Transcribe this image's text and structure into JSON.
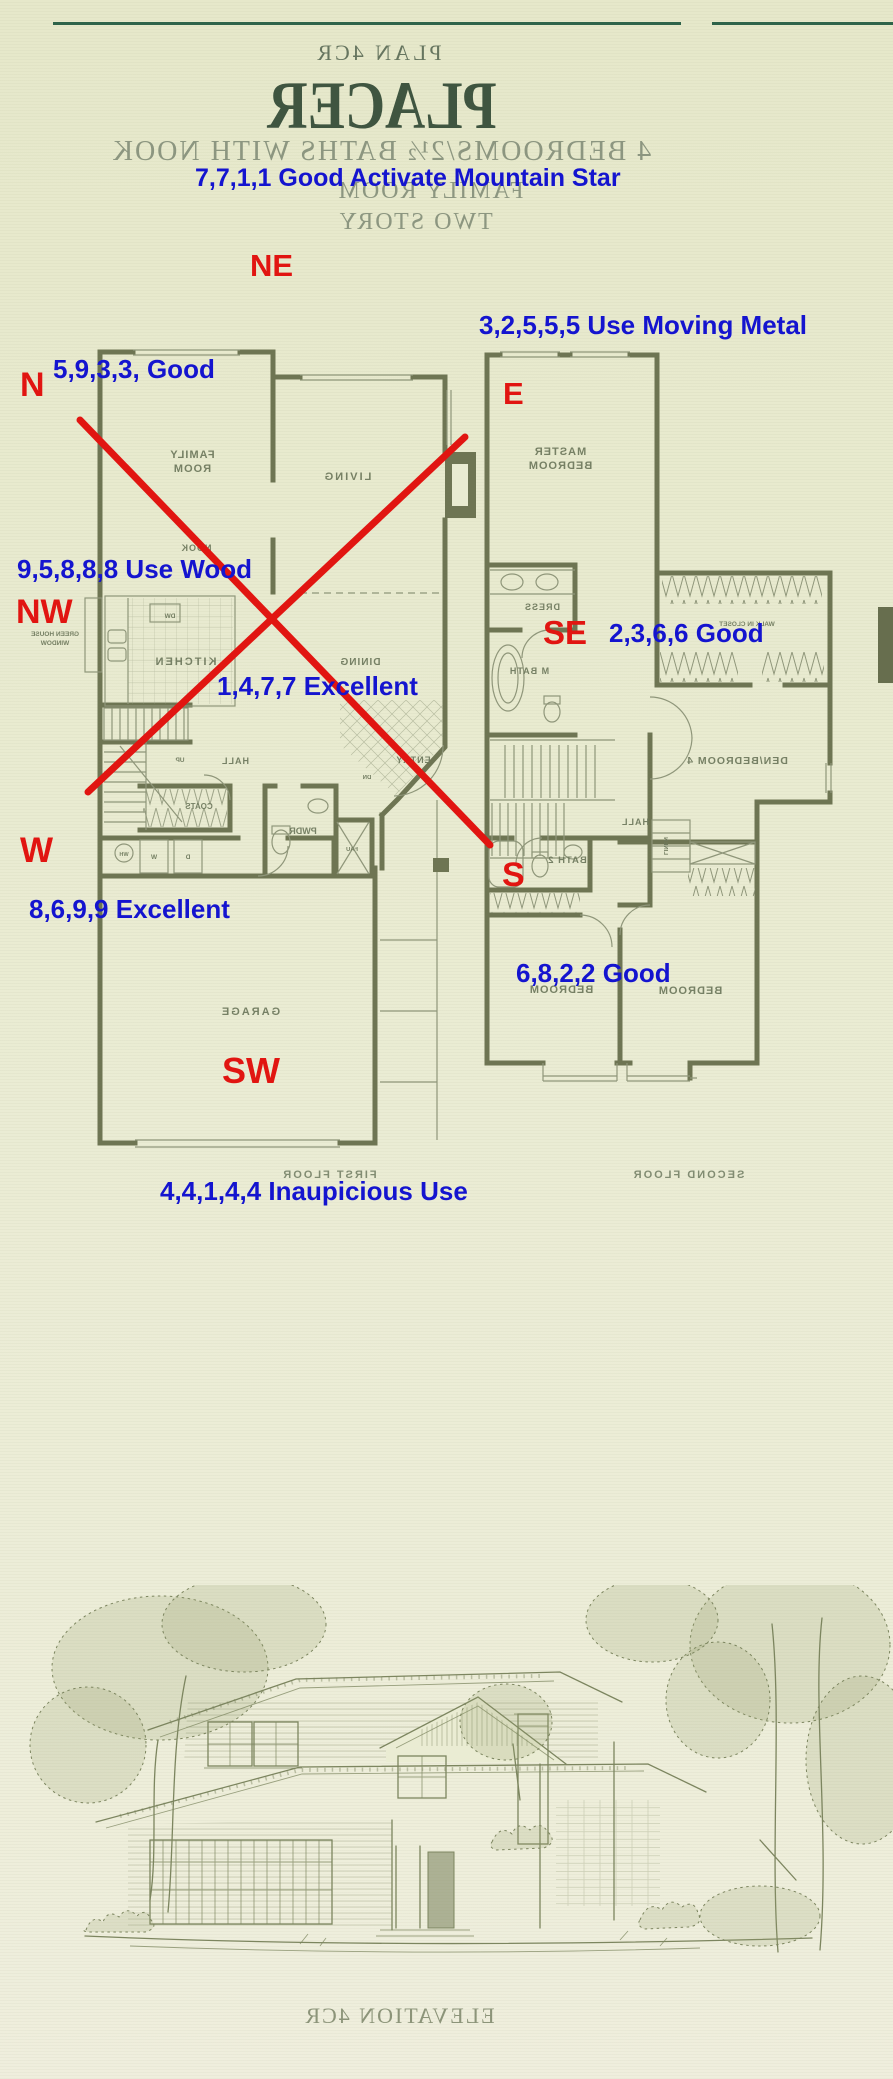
{
  "colors": {
    "blue": "#1414cf",
    "red": "#e11511",
    "wall": "#6e7553",
    "ink": "#7c855f",
    "title": "#3f5540",
    "faded": "#8c9680",
    "rule": "#2e6349"
  },
  "header": {
    "plan_code": "PLAN 4CR",
    "title": "PLACER",
    "subtitle": "4 BEDROOMS/2½ BATHS WITH NOOK",
    "line_family_room": "FAMILY ROOM",
    "line_two_story": "TWO STORY"
  },
  "feng_shui": {
    "notes": [
      {
        "text": "7,7,1,1 Good Activate Mountain Star"
      },
      {
        "text": "3,2,5,5,5  Use Moving Metal"
      },
      {
        "text": "5,9,3,3, Good"
      },
      {
        "text": "9,5,8,8,8 Use Wood"
      },
      {
        "text": "1,4,7,7 Excellent"
      },
      {
        "text": "2,3,6,6 Good"
      },
      {
        "text": "8,6,9,9 Excellent"
      },
      {
        "text": "6,8,2,2 Good"
      },
      {
        "text": "4,4,1,4,4 Inaupicious Use"
      }
    ],
    "directions": [
      {
        "text": "NE"
      },
      {
        "text": "N"
      },
      {
        "text": "E"
      },
      {
        "text": "NW"
      },
      {
        "text": "SE"
      },
      {
        "text": "W"
      },
      {
        "text": "S"
      },
      {
        "text": "SW"
      }
    ]
  },
  "floors": {
    "first": {
      "caption": "FIRST FLOOR",
      "labels": {
        "family": "FAMILY",
        "room": "ROOM",
        "living": "LIVING",
        "nook": "NOOK",
        "kitchen": "KITCHEN",
        "dining": "DINING",
        "hall": "HALL",
        "up": "UP",
        "coats": "COATS",
        "pwdr": "PWDR",
        "entry": "ENTRY",
        "dn": "DN",
        "fau": "FAU",
        "wh": "WH",
        "w": "W",
        "d": "D",
        "dw": "DW",
        "greenhouse1": "GREEN HOUSE",
        "greenhouse2": "WINDOW",
        "garage": "GARAGE"
      }
    },
    "second": {
      "caption": "SECOND FLOOR",
      "labels": {
        "master1": "MASTER",
        "master2": "BEDROOM",
        "dress": "DRESS",
        "mbath": "M BATH",
        "wic": "WALK IN CLOSET",
        "den": "DEN/BEDROOM 4",
        "hall": "HALL",
        "bath2": "BATH 2",
        "linen": "LINEN",
        "bedroom1": "BEDROOM",
        "bedroom2": "BEDROOM"
      }
    }
  },
  "footer": {
    "caption": "ELEVATION 4CR"
  }
}
